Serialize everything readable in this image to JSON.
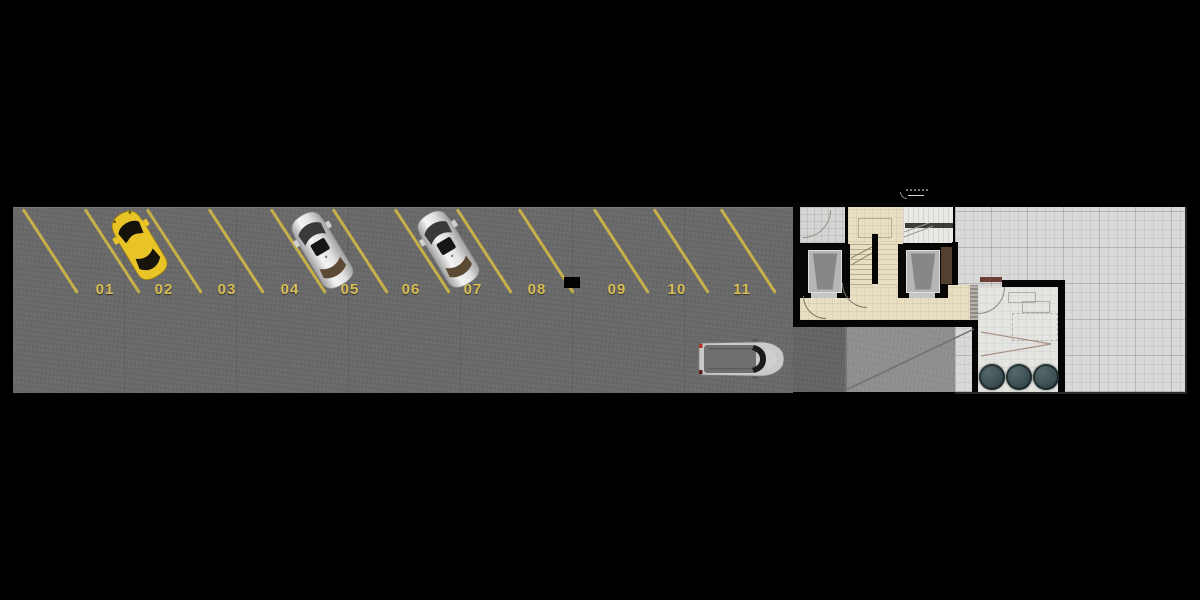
{
  "canvas": {
    "width": 1200,
    "height": 600,
    "background": "#000000"
  },
  "parking": {
    "surface_color": "#696969",
    "line_color": "#c7b04a",
    "label_color": "#d9bd55",
    "spaces": [
      {
        "label": "01",
        "cx": 105
      },
      {
        "label": "02",
        "cx": 164
      },
      {
        "label": "03",
        "cx": 227
      },
      {
        "label": "04",
        "cx": 290
      },
      {
        "label": "05",
        "cx": 350
      },
      {
        "label": "06",
        "cx": 411
      },
      {
        "label": "07",
        "cx": 473
      },
      {
        "label": "08",
        "cx": 537
      },
      {
        "label": "09",
        "cx": 617
      },
      {
        "label": "10",
        "cx": 677
      },
      {
        "label": "11",
        "cx": 742
      }
    ],
    "stall_line_bottoms": [
      77,
      139,
      201,
      263,
      325,
      387,
      449,
      511,
      573,
      648,
      708,
      775
    ],
    "column": {
      "x": 564,
      "y": 277,
      "w": 16,
      "h": 11
    },
    "cars": [
      {
        "kind": "hatchback",
        "body_color": "#e9c427",
        "cx": 139,
        "cy": 245,
        "angle": -31,
        "space": "02",
        "state": "parked"
      },
      {
        "kind": "sedan",
        "body_color": "#e2e2e2",
        "cx": 322,
        "cy": 250,
        "angle": -31,
        "space": "05",
        "state": "parked"
      },
      {
        "kind": "sedan",
        "body_color": "#e2e2e2",
        "cx": 448,
        "cy": 249,
        "angle": -31,
        "space": "07",
        "state": "parked"
      },
      {
        "kind": "suv",
        "body_color": "#c9c9c9",
        "cx": 742,
        "cy": 359,
        "angle": 0,
        "space": null,
        "state": "driving"
      }
    ]
  },
  "building": {
    "wall_color": "#050505",
    "lobby_floor_color": "#e8dec2",
    "exterior_tile_color": "#d8d8d6",
    "ramp_color": "#8f8f8f",
    "elevator_count": 2,
    "stair_count": 2,
    "plant_count": 3,
    "plant_color": "#3c4f52"
  }
}
